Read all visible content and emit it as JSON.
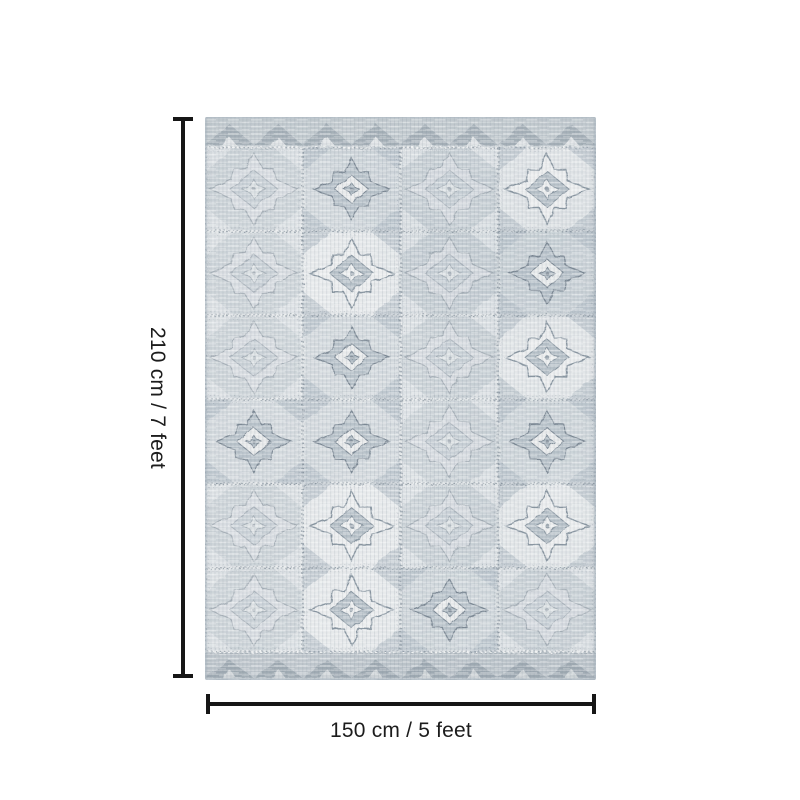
{
  "page": {
    "background": "#ffffff"
  },
  "dimensions": {
    "height_label": "210 cm / 7 feet",
    "width_label": "150 cm / 5 feet",
    "line_color": "#161616",
    "text_color": "#1c1c1c"
  },
  "rug": {
    "name": "distressed-gray-blue-aztec-tile-rug",
    "grid": {
      "columns": 4,
      "rows": 6
    },
    "palette": {
      "base": "#d3d9dc",
      "light": "#eaeced",
      "mid": "#aab6bf",
      "dark": "#7e8c98",
      "ink": "#6f7d8a",
      "band": "#93a0ab"
    }
  }
}
